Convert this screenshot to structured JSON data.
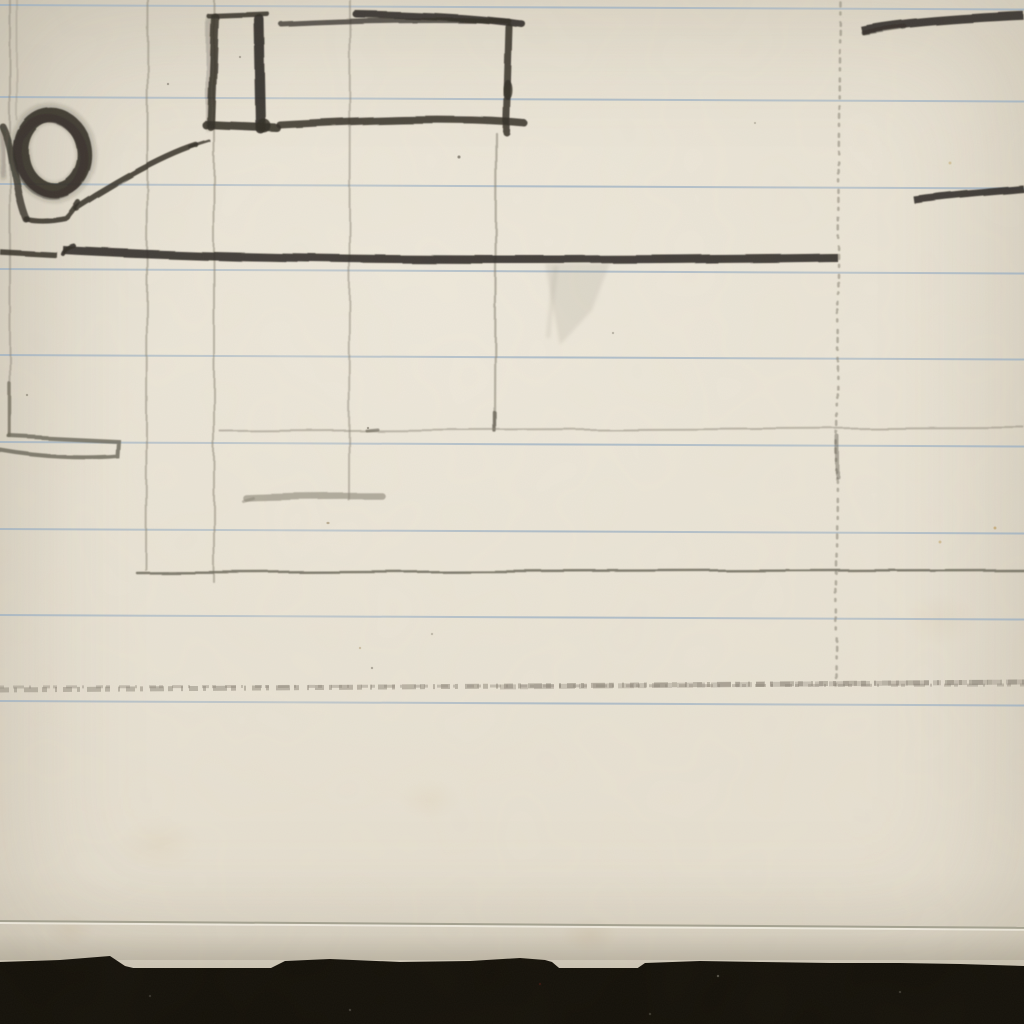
{
  "scene": {
    "description": "Close-up photograph of the lower part of a sketchbook page: a faint graphite perspective sketch with rectangles, a shaded ring, long horizontal charcoal strokes and light construction lines on cream ruled notebook paper; the torn bottom paper edge rests on a black background",
    "media": "graphite pencil on cream notebook paper with pale blue rules",
    "text_content": "none"
  },
  "palette": {
    "paper": "#e8e1d2",
    "rule_blue": "#9eb2c5",
    "graphite_dark": "#322e27",
    "graphite_medium": "#5f5a4f",
    "graphite_faint": "#8e887a",
    "pencil_line": "#6f6b5d",
    "smudge": "#8b8577",
    "edge_line": "#a5a291",
    "background_black": "#131009"
  },
  "ruled_lines": {
    "ys": [
      4,
      96,
      183,
      268,
      354,
      441,
      528,
      614,
      700
    ],
    "tilt_deg": 0.25,
    "count": 9
  },
  "page": {
    "bottom_score_line_y": 921,
    "black_band_top_y": 958
  }
}
